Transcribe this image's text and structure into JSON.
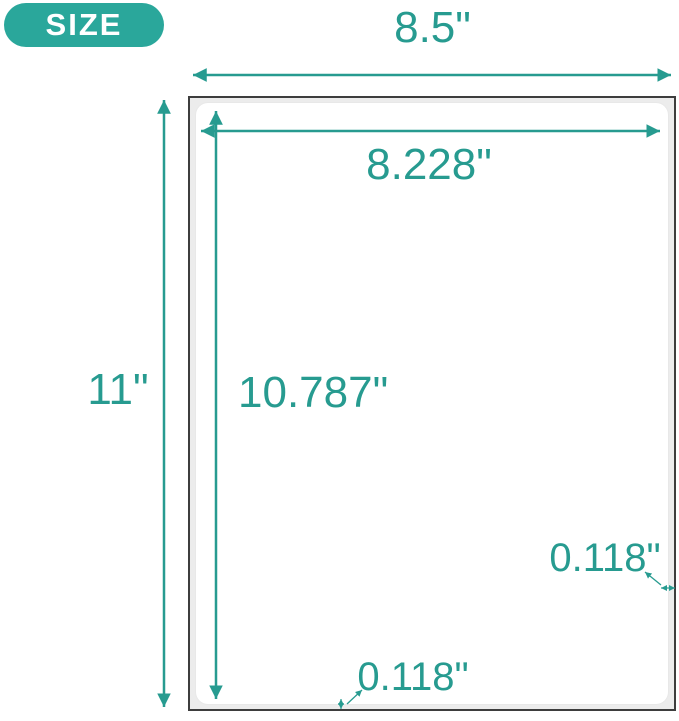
{
  "badge": {
    "label": "SIZE"
  },
  "diagram": {
    "type": "product-size-diagram",
    "sheet_width_label": "8.5\"",
    "sheet_height_label": "11\"",
    "label_width_label": "8.228\"",
    "label_height_label": "10.787\"",
    "bottom_margin_label": "0.118\"",
    "right_margin_label": "0.118\""
  },
  "colors": {
    "teal_accent": "#279b90",
    "badge_teal": "#2aa79b",
    "sheet_border": "#3d3d3d",
    "sheet_backing": "#ececec",
    "label_fill": "#ffffff",
    "background": "#ffffff"
  }
}
